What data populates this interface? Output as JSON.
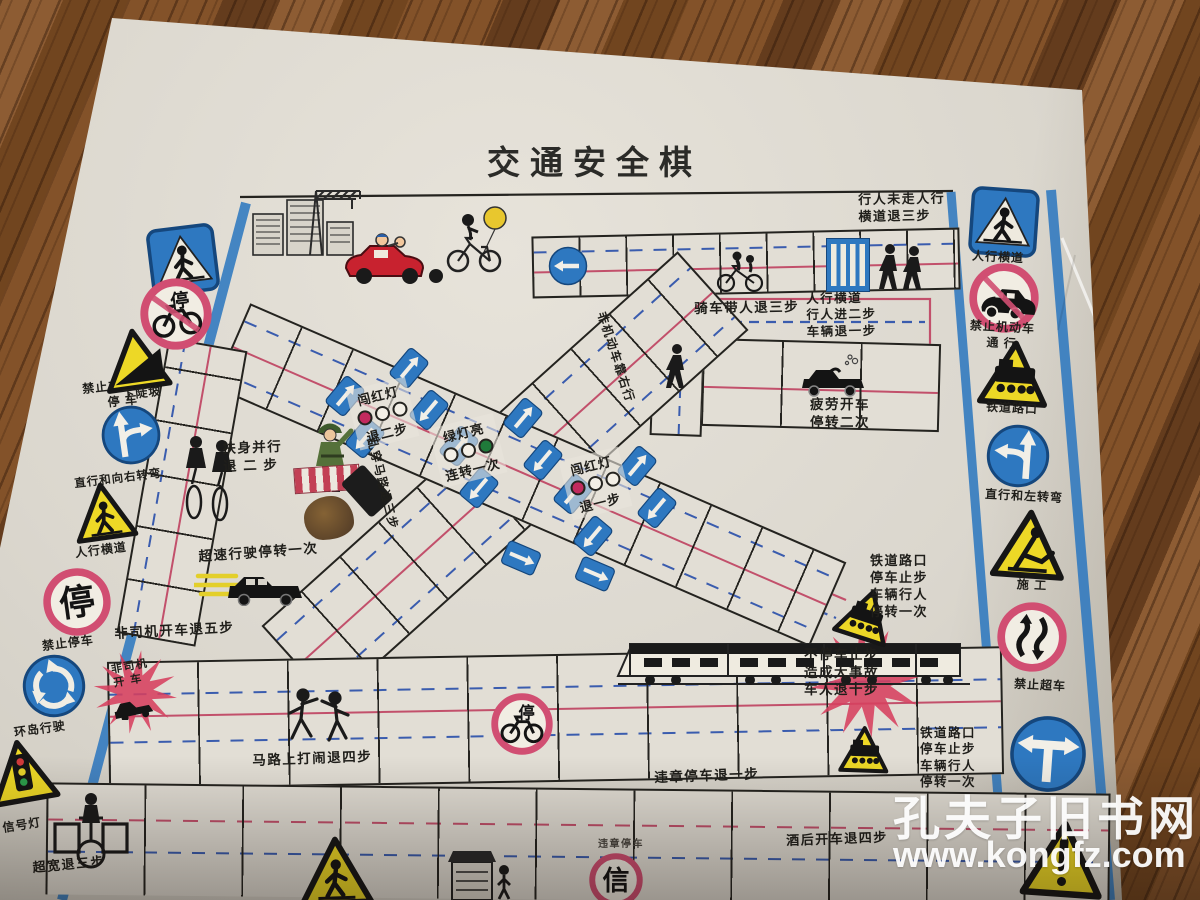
{
  "title": "交通安全棋",
  "watermark": {
    "site_name": "孔夫子旧书网",
    "site_url": "www.kongfz.com"
  },
  "colors": {
    "paper": "#dbd7ce",
    "wood": "#7b4b27",
    "sign_blue": "#2e78c0",
    "prohibit_red": "#d14e72",
    "lane_red": "#c2506b",
    "lane_blue": "#3a5cae",
    "warning_yellow": "#edd826",
    "starburst_red": "#d6405e",
    "green_light": "#1f7a3a",
    "red_light": "#c22a5e"
  },
  "signs": [
    {
      "cx": 183,
      "cy": 260,
      "s": 70,
      "rot": -7,
      "shape": "bs",
      "glyph": "crosswalk",
      "labels": [
        "人行横道"
      ],
      "lx": 183,
      "ly": 300,
      "lrot": -6
    },
    {
      "cx": 176,
      "cy": 314,
      "s": 72,
      "rot": -7,
      "shape": "rc",
      "glyph": "bike",
      "slash": true,
      "labels": [
        "禁止非机动车",
        "停    车"
      ],
      "lx": 122,
      "ly": 378,
      "lrot": -6
    },
    {
      "cx": 136,
      "cy": 360,
      "s": 66,
      "rot": -8,
      "shape": "yt",
      "glyph": "slope",
      "labels": [
        "下陡坡"
      ],
      "lx": 142,
      "ly": 386,
      "lrot": -6
    },
    {
      "cx": 131,
      "cy": 435,
      "s": 62,
      "rot": -8,
      "shape": "bc",
      "glyph": "straight-right",
      "labels": [
        "直行和向右转弯"
      ],
      "lx": 118,
      "ly": 472,
      "lrot": -7,
      "lfs": 11.5
    },
    {
      "cx": 104,
      "cy": 512,
      "s": 62,
      "rot": -8,
      "shape": "yt",
      "glyph": "crosswalk-warn",
      "labels": [
        "人行横道"
      ],
      "lx": 101,
      "ly": 543,
      "lrot": -7
    },
    {
      "cx": 77,
      "cy": 602,
      "s": 68,
      "rot": -8,
      "shape": "rc",
      "glyph": "stop-char",
      "labels": [
        "禁止停车"
      ],
      "lx": 68,
      "ly": 636,
      "lrot": -7
    },
    {
      "cx": 54,
      "cy": 686,
      "s": 66,
      "rot": -8,
      "shape": "bc",
      "glyph": "roundabout",
      "labels": [
        "环岛行驶"
      ],
      "lx": 40,
      "ly": 722,
      "lrot": -8
    },
    {
      "cx": 22,
      "cy": 772,
      "s": 68,
      "rot": -10,
      "shape": "yt",
      "glyph": "signal",
      "labels": [
        "信号灯"
      ],
      "lx": 22,
      "ly": 818,
      "lrot": -9
    },
    {
      "cx": 1004,
      "cy": 222,
      "s": 70,
      "rot": 4,
      "shape": "bs",
      "glyph": "crosswalk",
      "labels": [
        "人行横道"
      ],
      "lx": 998,
      "ly": 250,
      "lrot": 3
    },
    {
      "cx": 1004,
      "cy": 298,
      "s": 70,
      "rot": 4,
      "shape": "rc",
      "glyph": "car",
      "slash": true,
      "labels": [
        "禁止机动车",
        "通    行"
      ],
      "lx": 1002,
      "ly": 320,
      "lrot": 3
    },
    {
      "cx": 1014,
      "cy": 374,
      "s": 70,
      "rot": 4,
      "shape": "yt",
      "glyph": "train",
      "labels": [
        "铁道路口"
      ],
      "lx": 1012,
      "ly": 401,
      "lrot": 3
    },
    {
      "cx": 1018,
      "cy": 456,
      "s": 66,
      "rot": 4,
      "shape": "bc",
      "glyph": "straight-left",
      "labels": [
        "直行和左转弯"
      ],
      "lx": 1024,
      "ly": 489,
      "lrot": 3
    },
    {
      "cx": 1029,
      "cy": 545,
      "s": 74,
      "rot": 4,
      "shape": "yt",
      "glyph": "worker",
      "labels": [
        "施    工"
      ],
      "lx": 1032,
      "ly": 578,
      "lrot": 3
    },
    {
      "cx": 1032,
      "cy": 637,
      "s": 70,
      "rot": 4,
      "shape": "rc",
      "glyph": "overtake",
      "labels": [
        "禁止超车"
      ],
      "lx": 1040,
      "ly": 678,
      "lrot": 3
    },
    {
      "cx": 1048,
      "cy": 754,
      "s": 80,
      "rot": 4,
      "shape": "bc",
      "glyph": "t-junction",
      "labels": []
    },
    {
      "cx": 1063,
      "cy": 860,
      "s": 82,
      "rot": 4,
      "shape": "yt",
      "glyph": "exclaim",
      "labels": []
    },
    {
      "cx": 866,
      "cy": 615,
      "s": 56,
      "rot": 18,
      "shape": "yt",
      "glyph": "train",
      "labels": []
    },
    {
      "cx": 864,
      "cy": 750,
      "s": 50,
      "rot": 2,
      "shape": "yt",
      "glyph": "train",
      "labels": []
    },
    {
      "cx": 522,
      "cy": 724,
      "s": 62,
      "rot": 0,
      "shape": "rc",
      "glyph": "bike",
      "slash": false,
      "labels": []
    },
    {
      "cx": 616,
      "cy": 880,
      "s": 54,
      "rot": 0,
      "shape": "rc",
      "glyph": "xin-char",
      "labels": []
    },
    {
      "cx": 336,
      "cy": 872,
      "s": 74,
      "rot": -2,
      "shape": "yt",
      "glyph": "crosswalk-warn",
      "labels": []
    }
  ],
  "annotations": [
    {
      "x": 858,
      "y": 192,
      "fs": 13,
      "rot": -1,
      "lines": [
        "行人未走人行",
        "横道退三步"
      ]
    },
    {
      "x": 694,
      "y": 300,
      "fs": 13.5,
      "rot": -1,
      "lines": [
        "骑车带人退三步"
      ]
    },
    {
      "x": 806,
      "y": 291,
      "fs": 12.5,
      "rot": -1,
      "lines": [
        "人行横道",
        "行人进二步",
        "车辆退一步"
      ]
    },
    {
      "x": 810,
      "y": 396,
      "fs": 13.5,
      "rot": 0,
      "lines": [
        "疲劳开车",
        "停转二次"
      ]
    },
    {
      "x": 222,
      "y": 440,
      "fs": 13.5,
      "rot": -2,
      "lines": [
        "扶身并行",
        "退 二 步"
      ]
    },
    {
      "x": 198,
      "y": 548,
      "fs": 13.5,
      "rot": -4,
      "lines": [
        "超速行驶停转一次"
      ]
    },
    {
      "x": 114,
      "y": 625,
      "fs": 13.5,
      "rot": -3,
      "lines": [
        "非司机开车退五步"
      ]
    },
    {
      "x": 870,
      "y": 553,
      "fs": 13,
      "rot": 0,
      "lines": [
        "铁道路口",
        "停车止步",
        "车辆行人",
        "停转一次"
      ]
    },
    {
      "x": 804,
      "y": 646,
      "fs": 13.5,
      "rot": 0,
      "lines": [
        "不停车止步",
        "造成大事故",
        "车人退十步"
      ]
    },
    {
      "x": 252,
      "y": 752,
      "fs": 13.5,
      "rot": -2,
      "lines": [
        "马路上打闹退四步"
      ]
    },
    {
      "x": 654,
      "y": 769,
      "fs": 13.5,
      "rot": -2,
      "lines": [
        "违章停车退一步"
      ]
    },
    {
      "x": 786,
      "y": 833,
      "fs": 13,
      "rot": -2,
      "lines": [
        "酒后开车退四步"
      ]
    },
    {
      "x": 920,
      "y": 725,
      "fs": 12.5,
      "rot": 0,
      "lines": [
        "铁道路口",
        "停车止步",
        "车辆行人",
        "停转一次"
      ]
    },
    {
      "x": 32,
      "y": 860,
      "fs": 13,
      "rot": -5,
      "lines": [
        "超宽退三步"
      ]
    },
    {
      "x": 608,
      "y": 310,
      "fs": 12,
      "rot": 72,
      "lines": [
        "非机动车靠右行"
      ]
    },
    {
      "x": 378,
      "y": 436,
      "fs": 12,
      "rot": 76,
      "lines": [
        "乱穿马路退三步"
      ]
    },
    {
      "x": 598,
      "y": 838,
      "fs": 10,
      "rot": 0,
      "color": "#4a4640",
      "lines": [
        "违章停车"
      ]
    },
    {
      "x": 110,
      "y": 663,
      "fs": 11,
      "rot": -10,
      "lines": [
        "非司机",
        "开 车"
      ]
    }
  ],
  "lights": [
    {
      "x": 352,
      "y": 383,
      "rot": -14,
      "top": "闯红灯",
      "bottom": "退二步",
      "bulbs": [
        "#c22a5e",
        "#f3efe6",
        "#f3efe6"
      ]
    },
    {
      "x": 435,
      "y": 420,
      "rot": -14,
      "top": "绿灯亮",
      "bottom": "连转一次",
      "bulbs": [
        "#f3efe6",
        "#f3efe6",
        "#1f7a3a"
      ]
    },
    {
      "x": 565,
      "y": 453,
      "rot": -14,
      "top": "闯红灯",
      "bottom": "退一步",
      "bulbs": [
        "#c22a5e",
        "#f3efe6",
        "#f3efe6"
      ]
    }
  ],
  "arrow_tiles": [
    {
      "x": 332,
      "y": 378,
      "r": 40
    },
    {
      "x": 396,
      "y": 350,
      "r": 40
    },
    {
      "x": 352,
      "y": 420,
      "r": 220
    },
    {
      "x": 416,
      "y": 392,
      "r": 220
    },
    {
      "x": 446,
      "y": 428,
      "r": 40
    },
    {
      "x": 510,
      "y": 400,
      "r": 40
    },
    {
      "x": 466,
      "y": 470,
      "r": 220
    },
    {
      "x": 530,
      "y": 442,
      "r": 220
    },
    {
      "x": 560,
      "y": 476,
      "r": 40
    },
    {
      "x": 624,
      "y": 448,
      "r": 40
    },
    {
      "x": 580,
      "y": 518,
      "r": 220
    },
    {
      "x": 644,
      "y": 490,
      "r": 220
    },
    {
      "x": 508,
      "y": 540,
      "r": 113
    },
    {
      "x": 582,
      "y": 556,
      "r": 113
    }
  ],
  "scene": [
    {
      "name": "buildings",
      "x": 250,
      "y": 190,
      "w": 112,
      "h": 66
    },
    {
      "name": "crane",
      "x": 296,
      "y": 183,
      "w": 70,
      "h": 72
    },
    {
      "name": "family-car",
      "x": 338,
      "y": 230,
      "w": 118,
      "h": 56
    },
    {
      "name": "kid-bike",
      "x": 438,
      "y": 198,
      "w": 78,
      "h": 78
    },
    {
      "name": "cyclist-with-passenger",
      "x": 712,
      "y": 246,
      "w": 56,
      "h": 48
    },
    {
      "name": "crosswalk-cell",
      "x": 826,
      "y": 238,
      "w": 44,
      "h": 54
    },
    {
      "name": "pedestrians",
      "x": 874,
      "y": 242,
      "w": 56,
      "h": 52
    },
    {
      "name": "walking-person",
      "x": 660,
      "y": 342,
      "w": 34,
      "h": 52
    },
    {
      "name": "sleepy-car",
      "x": 792,
      "y": 350,
      "w": 80,
      "h": 48
    },
    {
      "name": "soldier",
      "x": 306,
      "y": 418,
      "w": 48,
      "h": 76
    },
    {
      "name": "speeding-car",
      "x": 194,
      "y": 558,
      "w": 115,
      "h": 48
    },
    {
      "name": "two-cyclists",
      "x": 176,
      "y": 430,
      "w": 64,
      "h": 92
    },
    {
      "name": "train",
      "x": 610,
      "y": 634,
      "w": 364,
      "h": 54
    },
    {
      "name": "fighting-people",
      "x": 284,
      "y": 686,
      "w": 72,
      "h": 58
    },
    {
      "name": "wide-cyclist",
      "x": 52,
      "y": 786,
      "w": 78,
      "h": 88
    },
    {
      "name": "kiosk",
      "x": 446,
      "y": 848,
      "w": 68,
      "h": 52
    },
    {
      "name": "crash-car",
      "x": 110,
      "y": 694,
      "w": 48,
      "h": 26
    },
    {
      "name": "start-arrow",
      "x": 548,
      "y": 246,
      "w": 40,
      "h": 40
    },
    {
      "name": "crosswalk-patch",
      "x": 294,
      "y": 466,
      "w": 64,
      "h": 24
    },
    {
      "name": "black-tile",
      "x": 352,
      "y": 468,
      "w": 30,
      "h": 46
    }
  ],
  "starbursts": [
    {
      "cx": 135,
      "cy": 692,
      "ro": 42,
      "ri": 18,
      "rot": 8
    },
    {
      "cx": 866,
      "cy": 682,
      "ro": 56,
      "ri": 25,
      "rot": -6
    }
  ]
}
